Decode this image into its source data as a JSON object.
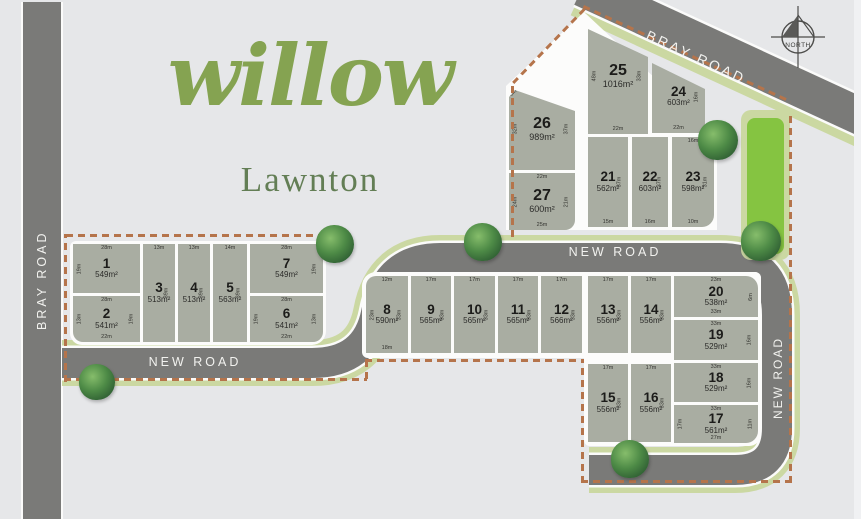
{
  "title": {
    "name": "willow",
    "suburb": "Lawnton"
  },
  "roads": {
    "bray_left": "BRAY ROAD",
    "bray_diagonal": "BRAY ROAD",
    "new_road_lower": "NEW ROAD",
    "new_road_upper": "NEW ROAD",
    "new_road_right": "NEW ROAD"
  },
  "compass": {
    "label": "NORTH"
  },
  "colors": {
    "background": "#e6e7e9",
    "road": "#7a7a78",
    "verge": "#cbd8a2",
    "park": "#85c441",
    "lot_fill": "#a9ada2",
    "boundary_dash": "#b5744b",
    "title_green": "#85a351",
    "suburb_green": "#637e55"
  },
  "lots": [
    {
      "id": "1",
      "number": "1",
      "area": "549m²",
      "dims": {
        "top": "28m",
        "left": "19m"
      }
    },
    {
      "id": "2",
      "number": "2",
      "area": "541m²",
      "dims": {
        "top": "28m",
        "left": "13m",
        "right": "19m",
        "bottom": "22m"
      }
    },
    {
      "id": "3",
      "number": "3",
      "area": "513m²",
      "dims": {
        "top": "13m",
        "right": "39m"
      }
    },
    {
      "id": "4",
      "number": "4",
      "area": "513m²",
      "dims": {
        "top": "13m",
        "right": "39m"
      }
    },
    {
      "id": "5",
      "number": "5",
      "area": "563m²",
      "dims": {
        "top": "14m",
        "right": "39m"
      }
    },
    {
      "id": "6",
      "number": "6",
      "area": "541m²",
      "dims": {
        "top": "28m",
        "left": "19m",
        "right": "13m",
        "bottom": "22m"
      }
    },
    {
      "id": "7",
      "number": "7",
      "area": "549m²",
      "dims": {
        "top": "28m",
        "right": "19m"
      }
    },
    {
      "id": "8",
      "number": "8",
      "area": "590m²",
      "dims": {
        "top": "12m",
        "left": "23m",
        "right": "33m",
        "bottom": "18m"
      }
    },
    {
      "id": "9",
      "number": "9",
      "area": "565m²",
      "dims": {
        "top": "17m",
        "right": "33m"
      }
    },
    {
      "id": "10",
      "number": "10",
      "area": "565m²",
      "dims": {
        "top": "17m",
        "right": "33m"
      }
    },
    {
      "id": "11",
      "number": "11",
      "area": "565m²",
      "dims": {
        "top": "17m",
        "right": "33m"
      }
    },
    {
      "id": "12",
      "number": "12",
      "area": "566m²",
      "dims": {
        "top": "17m",
        "right": "33m"
      }
    },
    {
      "id": "13",
      "number": "13",
      "area": "556m²",
      "dims": {
        "top": "17m",
        "right": "33m"
      }
    },
    {
      "id": "14",
      "number": "14",
      "area": "556m²",
      "dims": {
        "top": "17m",
        "right": "33m"
      }
    },
    {
      "id": "15",
      "number": "15",
      "area": "556m²",
      "dims": {
        "top": "17m",
        "right": "33m"
      }
    },
    {
      "id": "16",
      "number": "16",
      "area": "556m²",
      "dims": {
        "top": "17m",
        "right": "33m"
      }
    },
    {
      "id": "17",
      "number": "17",
      "area": "561m²",
      "dims": {
        "top": "33m",
        "left": "17m",
        "right": "11m",
        "bottom": "27m"
      }
    },
    {
      "id": "18",
      "number": "18",
      "area": "529m²",
      "dims": {
        "top": "33m",
        "right": "16m"
      }
    },
    {
      "id": "19",
      "number": "19",
      "area": "529m²",
      "dims": {
        "top": "33m",
        "right": "16m"
      }
    },
    {
      "id": "20",
      "number": "20",
      "area": "538m²",
      "dims": {
        "top": "23m",
        "right": "6m",
        "bottom": "33m"
      }
    },
    {
      "id": "21",
      "number": "21",
      "area": "562m²",
      "dims": {
        "right": "37m",
        "bottom": "15m"
      }
    },
    {
      "id": "22",
      "number": "22",
      "area": "603m²",
      "dims": {
        "right": "37m",
        "bottom": "16m"
      }
    },
    {
      "id": "23",
      "number": "23",
      "area": "598m²",
      "dims": {
        "top": "16m",
        "right": "31m",
        "bottom": "10m"
      }
    },
    {
      "id": "24",
      "number": "24",
      "area": "603m²",
      "dims": {
        "topd": "23m",
        "right": "16m",
        "bottom": "22m"
      }
    },
    {
      "id": "25",
      "number": "25",
      "area": "1016m²",
      "dims": {
        "topd": "29m",
        "left": "48m",
        "right": "33m",
        "bottom": "22m"
      }
    },
    {
      "id": "26",
      "number": "26",
      "area": "989m²",
      "dims": {
        "tl": "8m",
        "topd": "24m",
        "left": "32m",
        "right": "37m"
      }
    },
    {
      "id": "27",
      "number": "27",
      "area": "600m²",
      "dims": {
        "top": "22m",
        "left": "24m",
        "right": "21m",
        "bottom": "25m"
      }
    }
  ]
}
